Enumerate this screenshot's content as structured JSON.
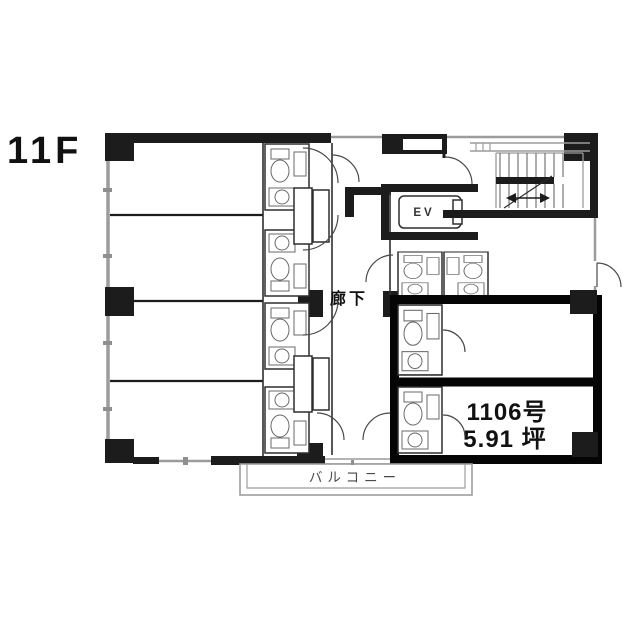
{
  "floor_label": "11F",
  "plan": {
    "corridor_label": "廊下",
    "elevator_label": "EV",
    "balcony_label": "バルコニー",
    "highlighted_unit": {
      "number": "1106号",
      "area": "5.91 坪"
    }
  },
  "colors": {
    "background": "#ffffff",
    "wall_black": "#1c1c1c",
    "wall_gray": "#9c9c9c",
    "highlight_border": "#050505",
    "text": "#111111"
  }
}
